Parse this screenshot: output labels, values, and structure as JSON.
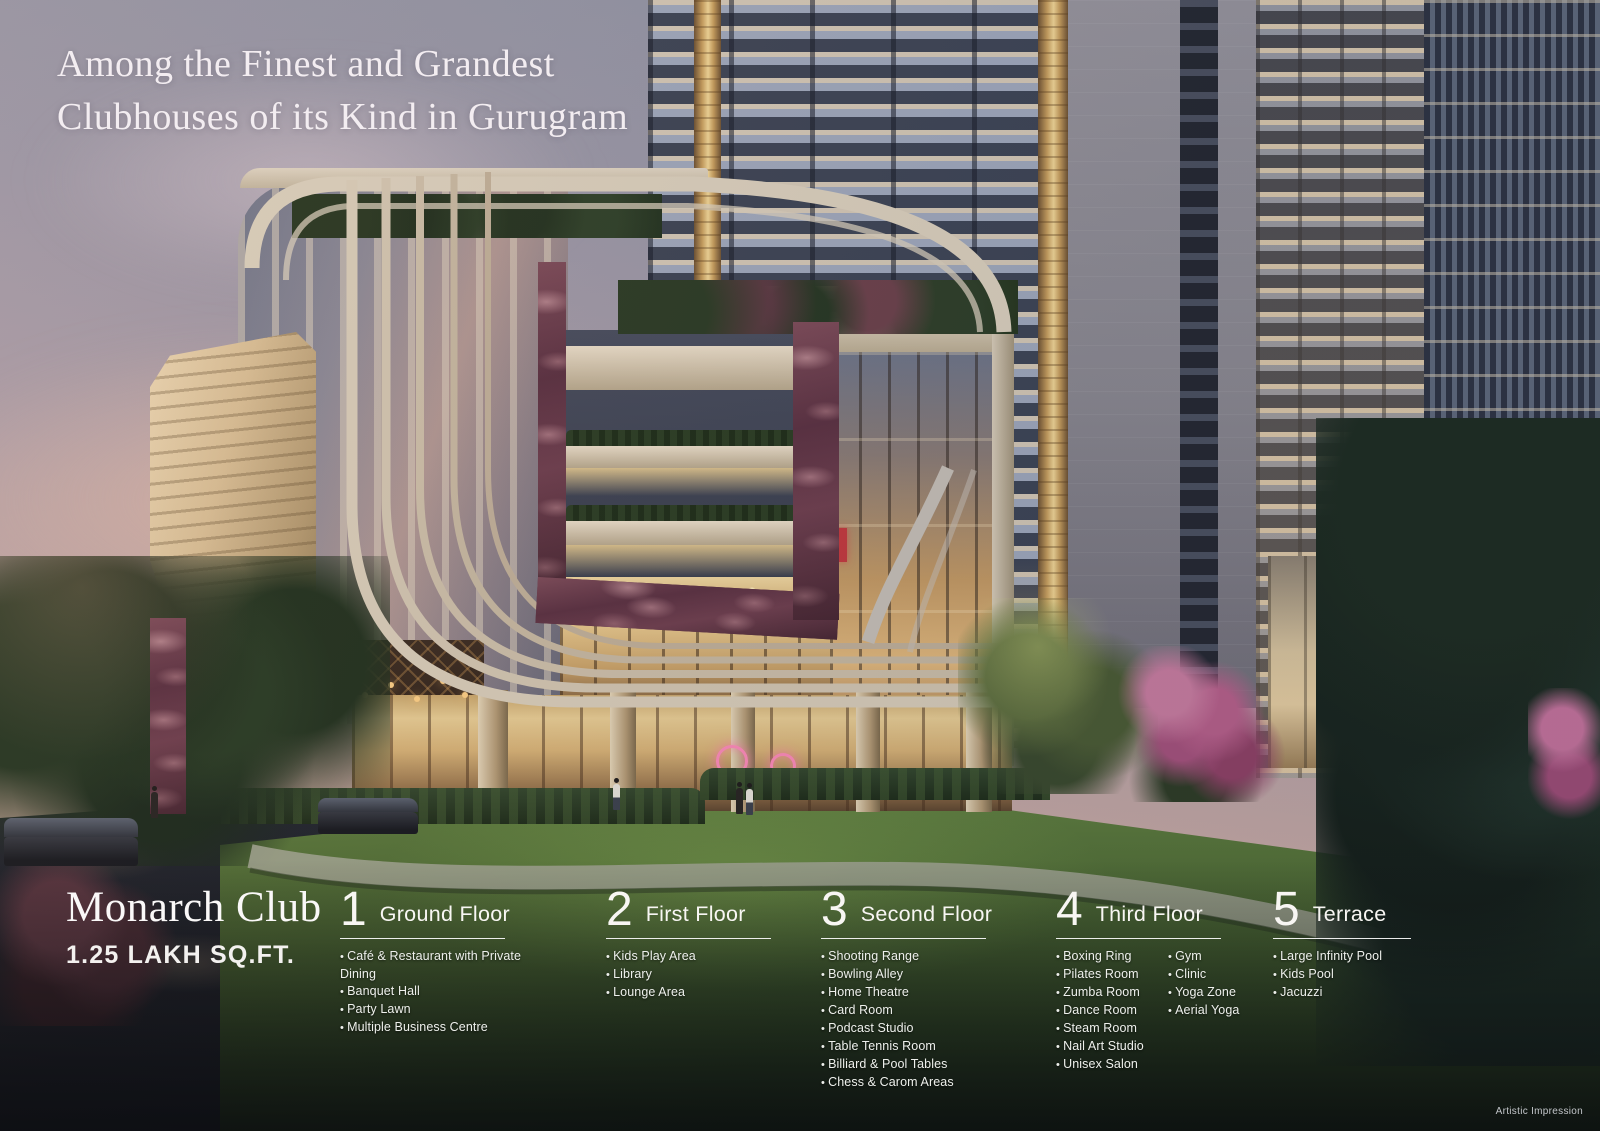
{
  "headline": {
    "line1": "Among the Finest and Grandest",
    "line2": "Clubhouses of its Kind in Gurugram"
  },
  "club": {
    "name": "Monarch Club",
    "area": "1.25 LAKH SQ.FT."
  },
  "floors": [
    {
      "number": "1",
      "label": "Ground Floor",
      "items": [
        "Café & Restaurant with Private Dining",
        "Banquet Hall",
        "Party Lawn",
        "Multiple Business Centre"
      ]
    },
    {
      "number": "2",
      "label": "First Floor",
      "items": [
        "Kids Play Area",
        "Library",
        "Lounge Area"
      ]
    },
    {
      "number": "3",
      "label": "Second Floor",
      "items": [
        "Shooting Range",
        "Bowling Alley",
        "Home Theatre",
        "Card Room",
        "Podcast Studio",
        "Table Tennis Room",
        "Billiard & Pool Tables",
        "Chess & Carom Areas"
      ]
    },
    {
      "number": "4",
      "label": "Third Floor",
      "items": [
        "Boxing Ring",
        "Pilates Room",
        "Zumba Room",
        "Dance Room",
        "Steam Room",
        "Nail Art Studio",
        "Unisex Salon"
      ],
      "items2": [
        "Gym",
        "Clinic",
        "Yoga Zone",
        "Aerial Yoga"
      ]
    },
    {
      "number": "5",
      "label": "Terrace",
      "items": [
        "Large Infinity Pool",
        "Kids Pool",
        "Jacuzzi"
      ]
    }
  ],
  "footnote": "Artistic Impression",
  "scene": {
    "colors": {
      "sky_top": "#8e93a3",
      "sky_pink": "#eecdb7",
      "facade_cream": "#d6cab6",
      "marble_maroon": "#5e3242",
      "gold_light": "#f3d795",
      "lawn_green": "#46612c",
      "neon_pink": "#ff8ab8"
    }
  }
}
